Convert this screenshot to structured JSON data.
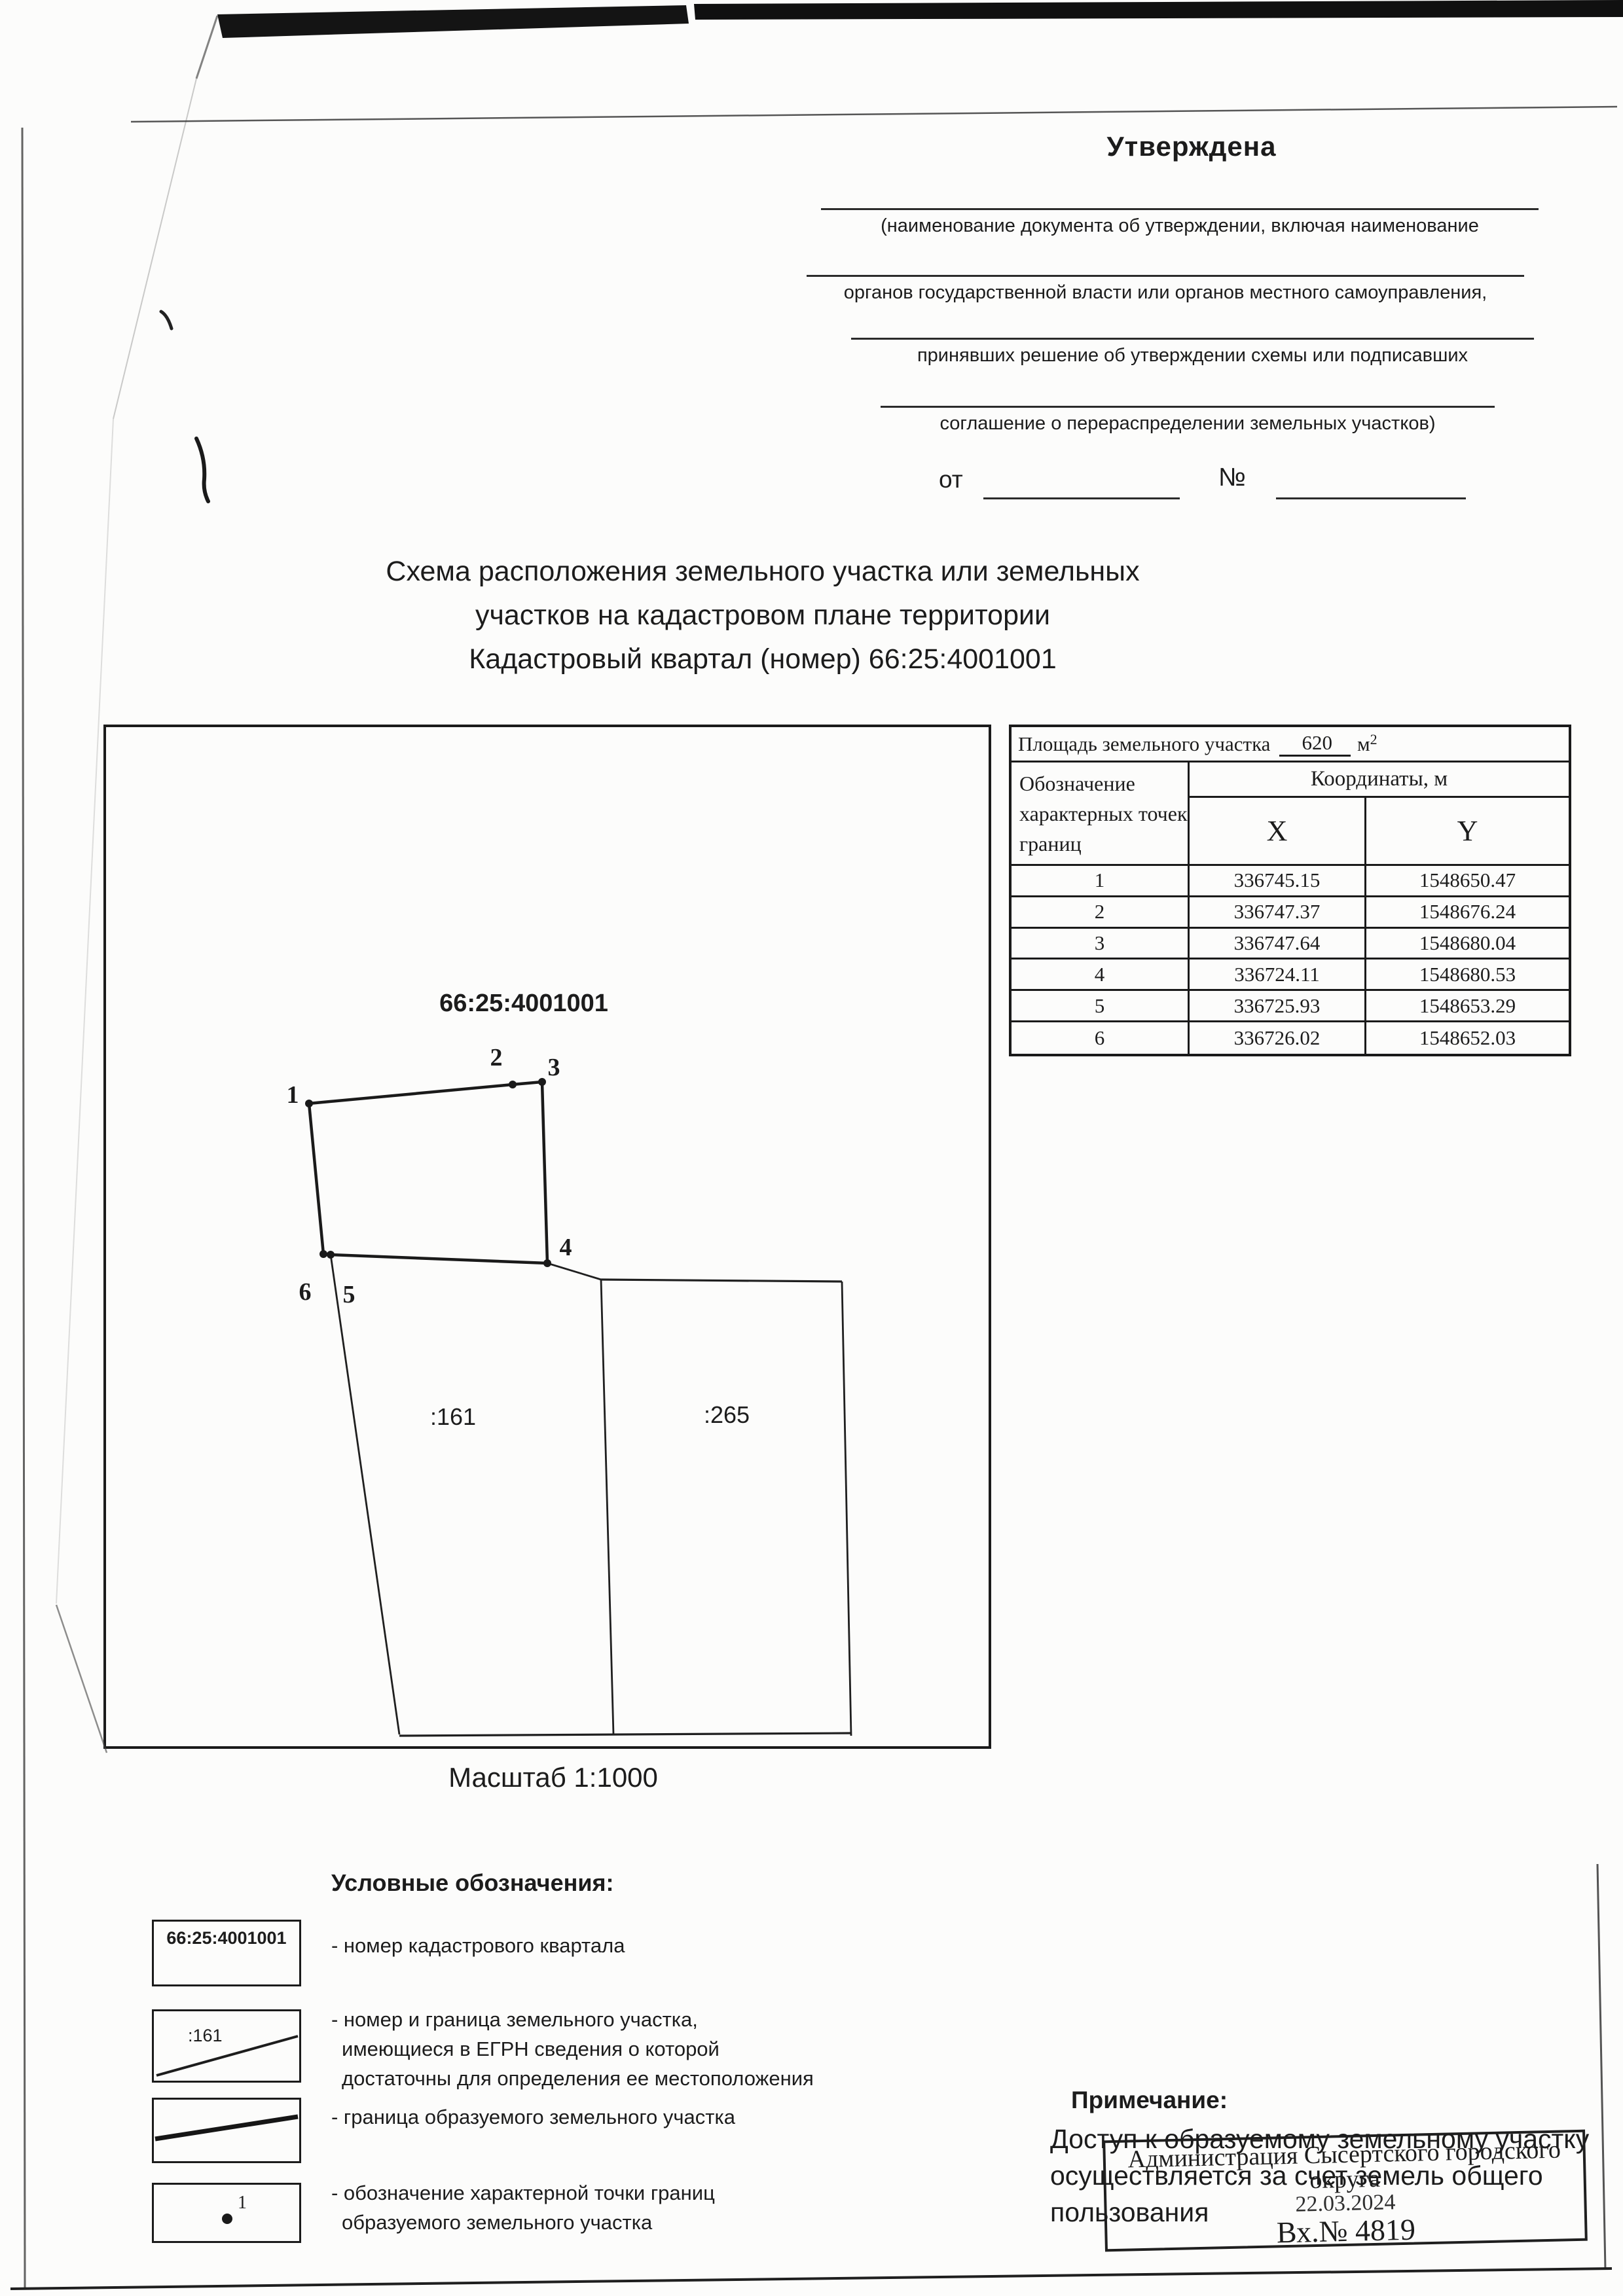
{
  "header": {
    "approved": "Утверждена",
    "fill_captions": [
      "(наименование документа об утверждении, включая наименование",
      "органов государственной власти или органов местного самоуправления,",
      "принявших решение об утверждении схемы или подписавших",
      "соглашение о перераспределении земельных участков)"
    ],
    "from_label": "от",
    "number_label": "№"
  },
  "title": {
    "line1": "Схема расположения земельного участка или земельных",
    "line2": "участков на кадастровом плане территории",
    "line3": "Кадастровый квартал (номер) 66:25:4001001"
  },
  "map": {
    "quarter_number": "66:25:4001001",
    "parcel_left": ":161",
    "parcel_right": ":265",
    "point_labels": [
      "1",
      "2",
      "3",
      "4",
      "5",
      "6"
    ],
    "scale_label": "Масштаб  1:1000"
  },
  "area_table": {
    "area_label": "Площадь земельного участка",
    "area_value": "620",
    "area_unit": "м",
    "area_unit_exp": "2",
    "col_point_header": "Обозначение характерных точек границ",
    "col_coords_header": "Координаты, м",
    "col_x": "X",
    "col_y": "Y",
    "rows": [
      {
        "n": "1",
        "x": "336745.15",
        "y": "1548650.47"
      },
      {
        "n": "2",
        "x": "336747.37",
        "y": "1548676.24"
      },
      {
        "n": "3",
        "x": "336747.64",
        "y": "1548680.04"
      },
      {
        "n": "4",
        "x": "336724.11",
        "y": "1548680.53"
      },
      {
        "n": "5",
        "x": "336725.93",
        "y": "1548653.29"
      },
      {
        "n": "6",
        "x": "336726.02",
        "y": "1548652.03"
      }
    ]
  },
  "legend": {
    "heading": "Условные обозначения:",
    "item1_symbol": "66:25:4001001",
    "item1_caption": "- номер кадастрового квартала",
    "item2_symbol": ":161",
    "item2_caption_l1": "- номер и граница земельного участка,",
    "item2_caption_l2": "имеющиеся в ЕГРН сведения о которой",
    "item2_caption_l3": "достаточны для определения ее местоположения",
    "item3_caption": "- граница образуемого земельного участка",
    "item4_point_label": "1",
    "item4_caption_l1": "- обозначение характерной точки границ",
    "item4_caption_l2": "образуемого земельного участка"
  },
  "note": {
    "heading": "Примечание:",
    "line1": "Доступ к образуемому земельному участку",
    "line2": "осуществляется за счет земель общего",
    "line3": "пользования"
  },
  "stamp": {
    "org_line1": "Администрация Сысертского городского",
    "org_line2": "округа",
    "date": "22.03.2024",
    "number": "Вх.№ 4819"
  },
  "colors": {
    "ink": "#1c1c1c",
    "paper": "#fcfcfb"
  }
}
